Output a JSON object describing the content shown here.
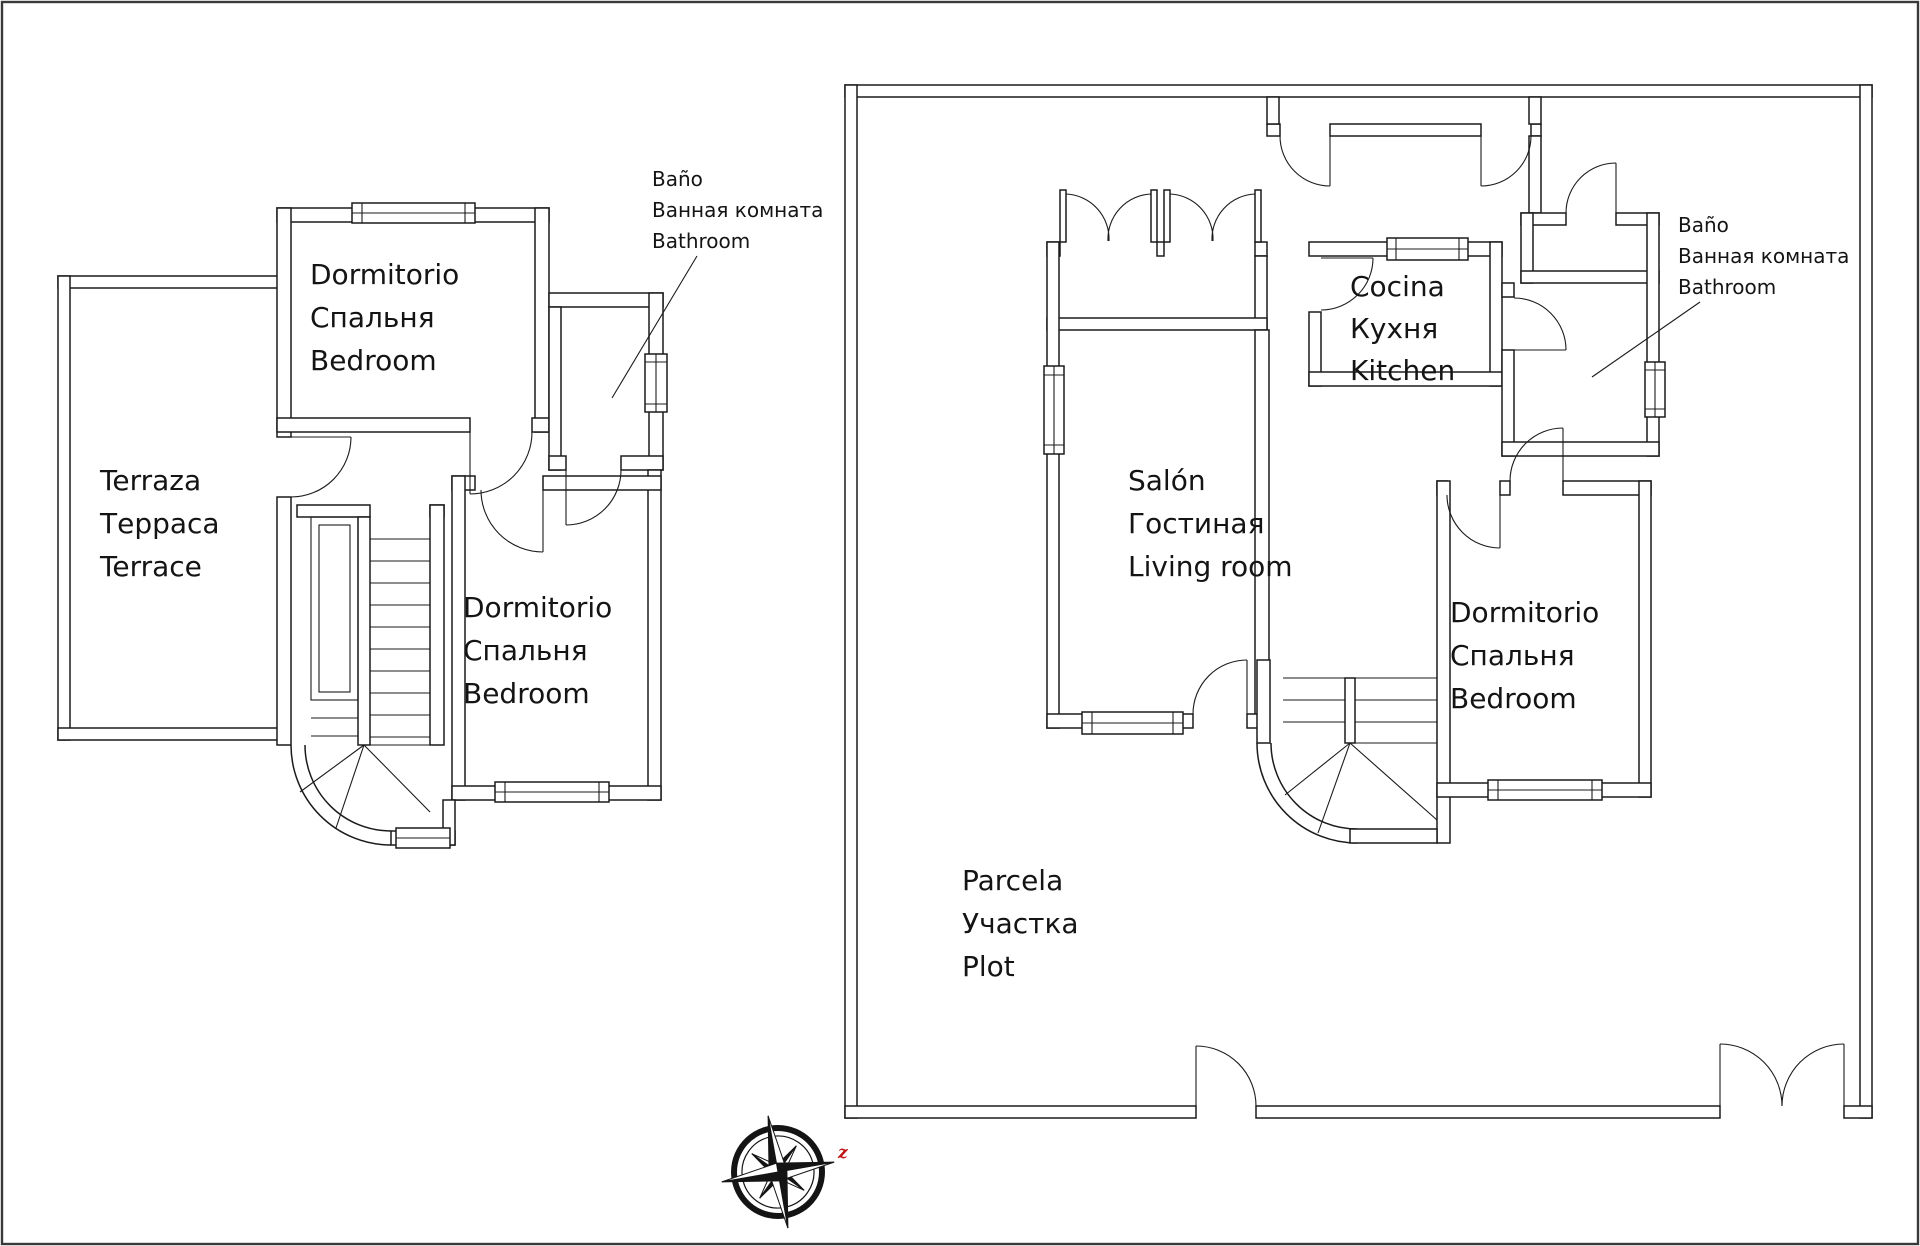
{
  "floor2": {
    "bedroom_top": {
      "lines": [
        "Dormitorio",
        "Спальня",
        "Bedroom"
      ]
    },
    "terrace": {
      "lines": [
        "Terraza",
        "Терраса",
        "Terrace"
      ]
    },
    "bedroom_bottom": {
      "lines": [
        "Dormitorio",
        "Спальня",
        "Bedroom"
      ]
    },
    "bathroom": {
      "lines": [
        "Baño",
        "Ванная комната",
        "Bathroom"
      ]
    }
  },
  "floor1": {
    "kitchen": {
      "lines": [
        "Cocina",
        "Кухня",
        "Kitchen"
      ]
    },
    "living_room": {
      "lines": [
        "Salón",
        "Гостиная",
        "Living room"
      ]
    },
    "bedroom": {
      "lines": [
        "Dormitorio",
        "Спальня",
        "Bedroom"
      ]
    },
    "bathroom": {
      "lines": [
        "Baño",
        "Ванная комната",
        "Bathroom"
      ]
    },
    "plot": {
      "lines": [
        "Parcela",
        "Участка",
        "Plot"
      ]
    }
  },
  "compass": {
    "east_letter": "z"
  },
  "colors": {
    "line": "#1b1b1b",
    "accent": "#c01414",
    "background": "#ffffff"
  }
}
